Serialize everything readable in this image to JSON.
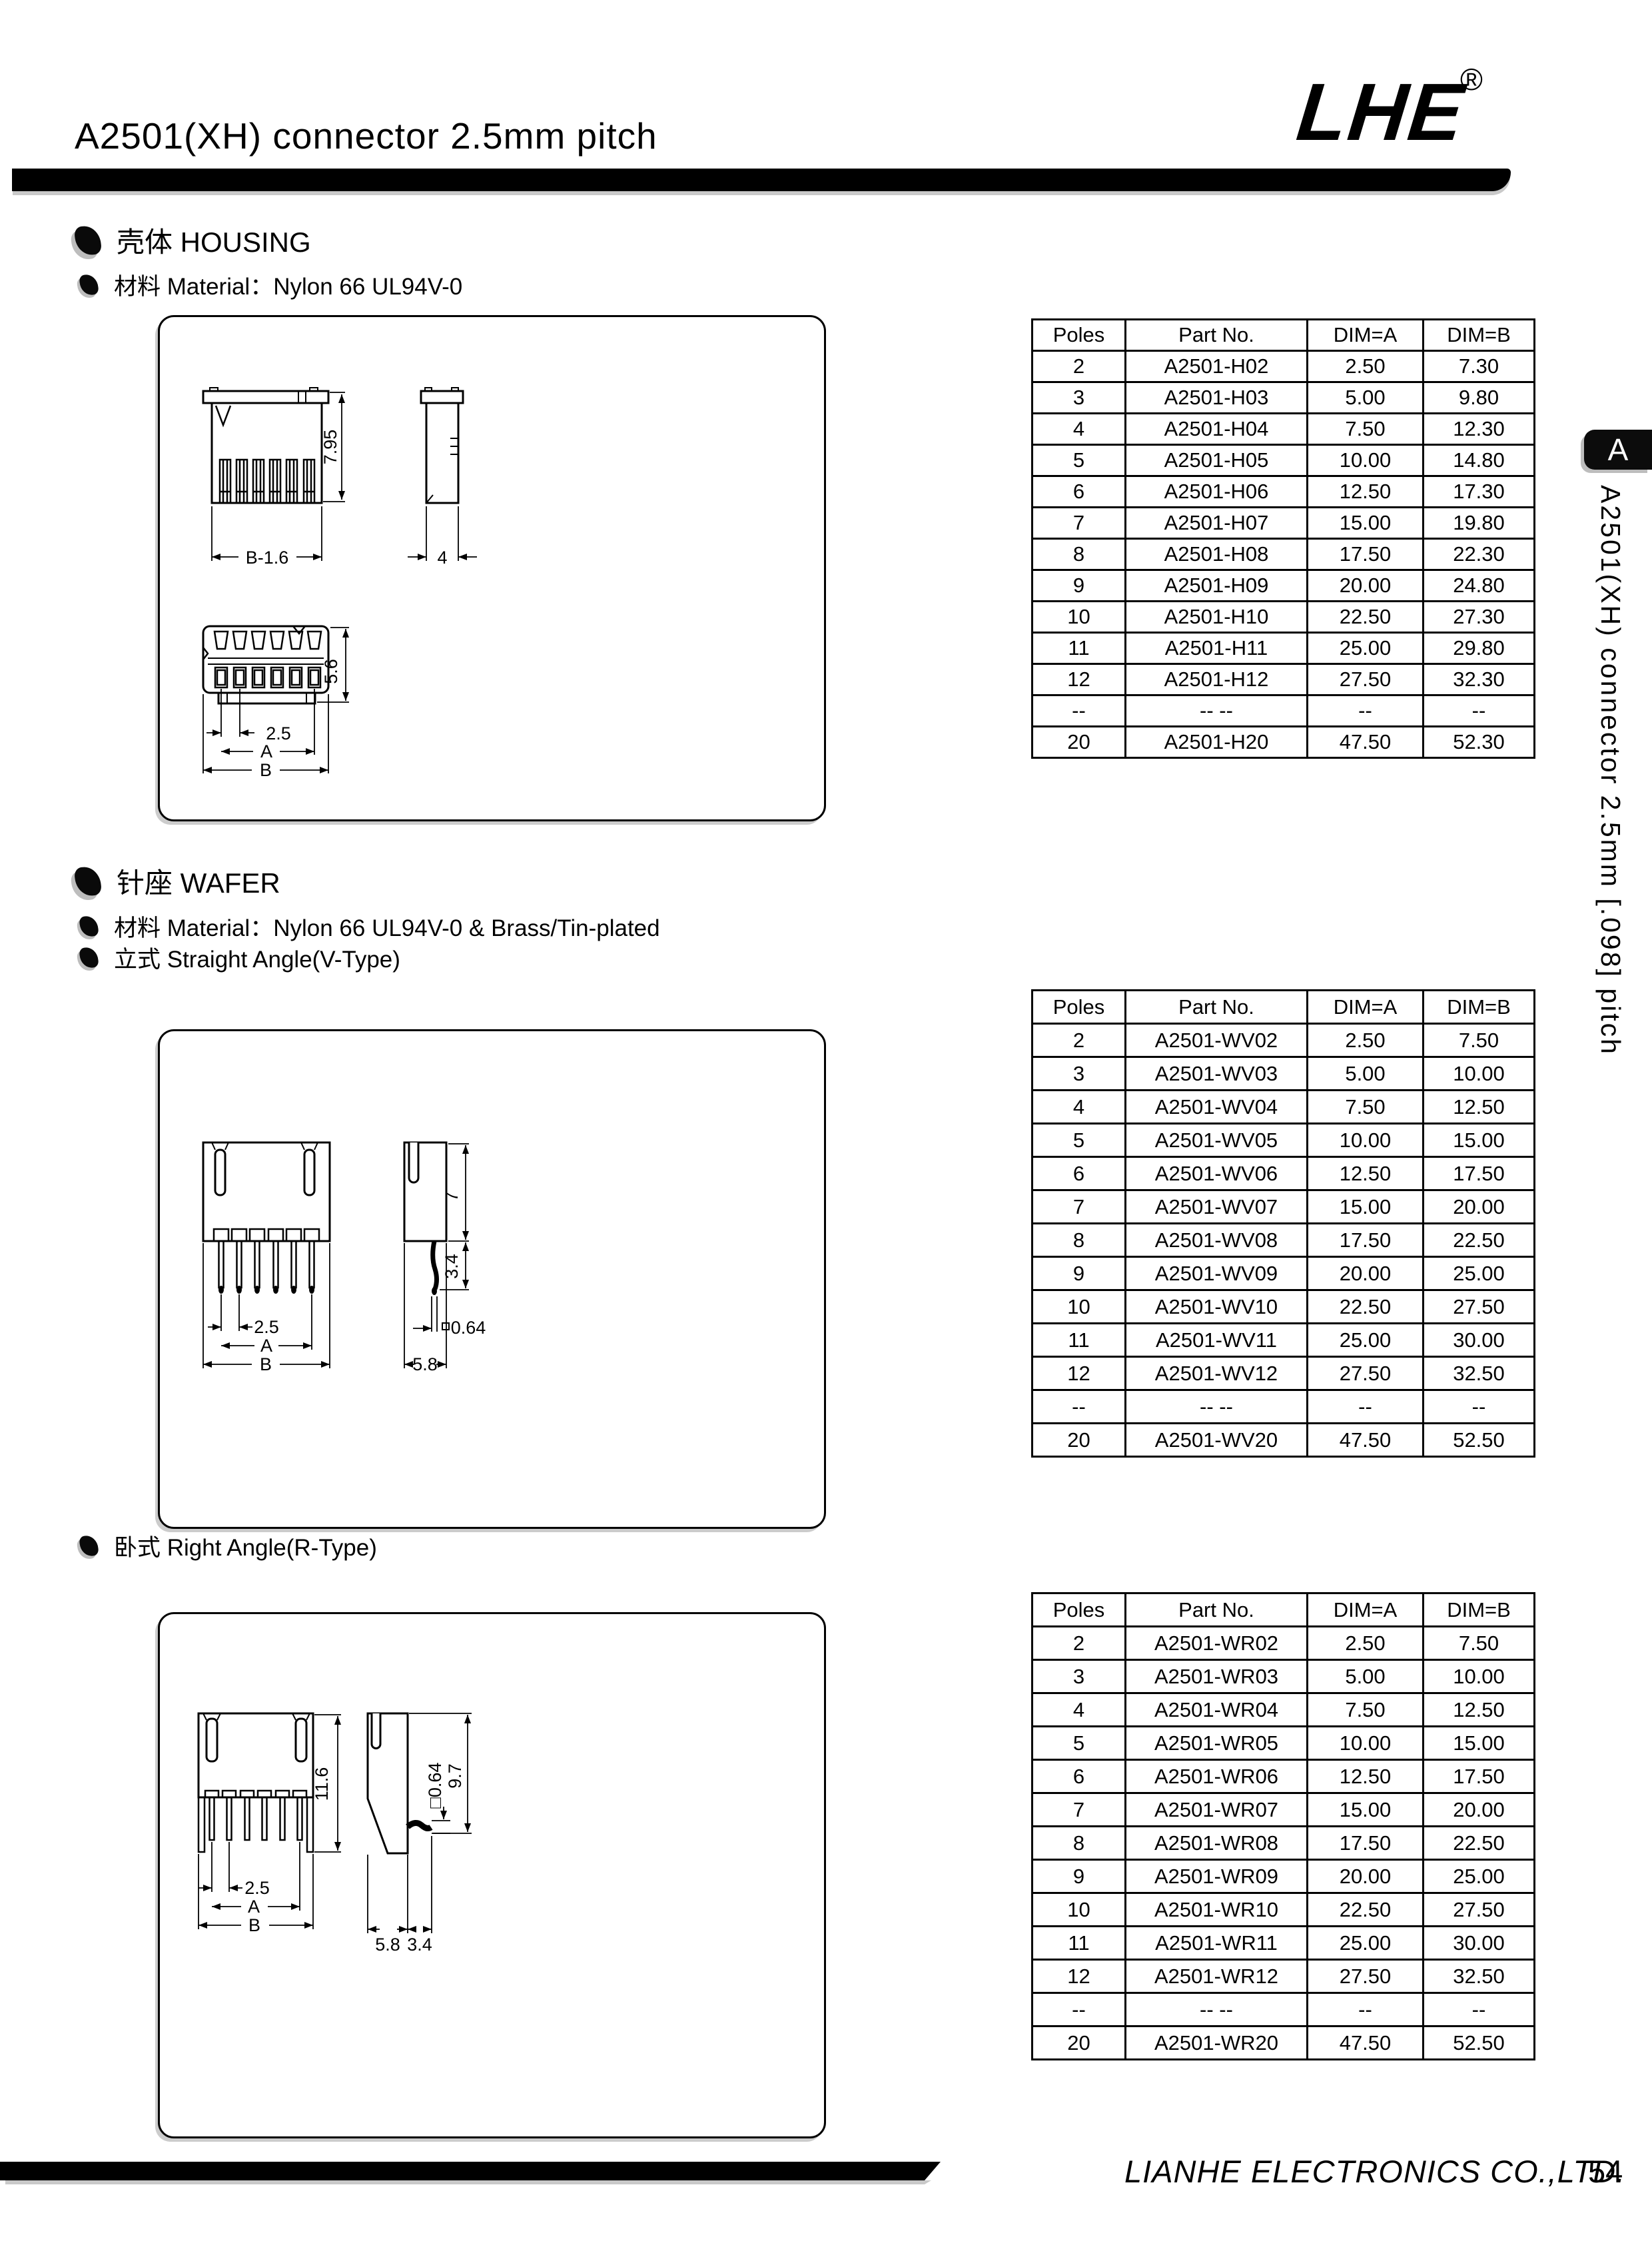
{
  "header": {
    "title": "A2501(XH) connector 2.5mm pitch",
    "logo_text": "LHE",
    "logo_reg": "®"
  },
  "sections": {
    "housing": {
      "heading": "壳体 HOUSING",
      "material": "材料 Material：Nylon 66 UL94V-0"
    },
    "wafer": {
      "heading": "针座 WAFER",
      "material": "材料 Material：Nylon 66 UL94V-0 & Brass/Tin-plated",
      "v_type": "立式 Straight Angle(V-Type)",
      "r_type": "卧式 Right Angle(R-Type)"
    }
  },
  "tables": {
    "columns": [
      "Poles",
      "Part No.",
      "DIM=A",
      "DIM=B"
    ],
    "housing": {
      "rows": [
        [
          "2",
          "A2501-H02",
          "2.50",
          "7.30"
        ],
        [
          "3",
          "A2501-H03",
          "5.00",
          "9.80"
        ],
        [
          "4",
          "A2501-H04",
          "7.50",
          "12.30"
        ],
        [
          "5",
          "A2501-H05",
          "10.00",
          "14.80"
        ],
        [
          "6",
          "A2501-H06",
          "12.50",
          "17.30"
        ],
        [
          "7",
          "A2501-H07",
          "15.00",
          "19.80"
        ],
        [
          "8",
          "A2501-H08",
          "17.50",
          "22.30"
        ],
        [
          "9",
          "A2501-H09",
          "20.00",
          "24.80"
        ],
        [
          "10",
          "A2501-H10",
          "22.50",
          "27.30"
        ],
        [
          "11",
          "A2501-H11",
          "25.00",
          "29.80"
        ],
        [
          "12",
          "A2501-H12",
          "27.50",
          "32.30"
        ],
        [
          "--",
          "-- --",
          "--",
          "--"
        ],
        [
          "20",
          "A2501-H20",
          "47.50",
          "52.30"
        ]
      ]
    },
    "wafer_v": {
      "rows": [
        [
          "2",
          "A2501-WV02",
          "2.50",
          "7.50"
        ],
        [
          "3",
          "A2501-WV03",
          "5.00",
          "10.00"
        ],
        [
          "4",
          "A2501-WV04",
          "7.50",
          "12.50"
        ],
        [
          "5",
          "A2501-WV05",
          "10.00",
          "15.00"
        ],
        [
          "6",
          "A2501-WV06",
          "12.50",
          "17.50"
        ],
        [
          "7",
          "A2501-WV07",
          "15.00",
          "20.00"
        ],
        [
          "8",
          "A2501-WV08",
          "17.50",
          "22.50"
        ],
        [
          "9",
          "A2501-WV09",
          "20.00",
          "25.00"
        ],
        [
          "10",
          "A2501-WV10",
          "22.50",
          "27.50"
        ],
        [
          "11",
          "A2501-WV11",
          "25.00",
          "30.00"
        ],
        [
          "12",
          "A2501-WV12",
          "27.50",
          "32.50"
        ],
        [
          "--",
          "-- --",
          "--",
          "--"
        ],
        [
          "20",
          "A2501-WV20",
          "47.50",
          "52.50"
        ]
      ]
    },
    "wafer_r": {
      "rows": [
        [
          "2",
          "A2501-WR02",
          "2.50",
          "7.50"
        ],
        [
          "3",
          "A2501-WR03",
          "5.00",
          "10.00"
        ],
        [
          "4",
          "A2501-WR04",
          "7.50",
          "12.50"
        ],
        [
          "5",
          "A2501-WR05",
          "10.00",
          "15.00"
        ],
        [
          "6",
          "A2501-WR06",
          "12.50",
          "17.50"
        ],
        [
          "7",
          "A2501-WR07",
          "15.00",
          "20.00"
        ],
        [
          "8",
          "A2501-WR08",
          "17.50",
          "22.50"
        ],
        [
          "9",
          "A2501-WR09",
          "20.00",
          "25.00"
        ],
        [
          "10",
          "A2501-WR10",
          "22.50",
          "27.50"
        ],
        [
          "11",
          "A2501-WR11",
          "25.00",
          "30.00"
        ],
        [
          "12",
          "A2501-WR12",
          "27.50",
          "32.50"
        ],
        [
          "--",
          "-- --",
          "--",
          "--"
        ],
        [
          "20",
          "A2501-WR20",
          "47.50",
          "52.50"
        ]
      ]
    }
  },
  "drawings": {
    "housing": {
      "dims": {
        "height": "7.95",
        "body_width": "B-1.6",
        "side_width": "4",
        "stack_height": "5.6",
        "pitch": "2.5",
        "dim_a": "A",
        "dim_b": "B"
      }
    },
    "wafer_v": {
      "dims": {
        "pitch": "2.5",
        "dim_a": "A",
        "dim_b": "B",
        "height": "7",
        "pin_below": "3.4",
        "pin_square": "□",
        "pin_size": "0.64",
        "depth": "5.8"
      }
    },
    "wafer_r": {
      "dims": {
        "height": "11.6",
        "pitch": "2.5",
        "dim_a": "A",
        "dim_b": "B",
        "pin_square_size": "□0.64",
        "pin_height": "9.7",
        "depth": "5.8",
        "pin_out": "3.4"
      }
    }
  },
  "sidebar": {
    "tab": "A",
    "vertical_title": "A2501(XH) connector 2.5mm [.098] pitch"
  },
  "footer": {
    "company": "LIANHE ELECTRONICS CO.,LTD.",
    "page": "54"
  }
}
